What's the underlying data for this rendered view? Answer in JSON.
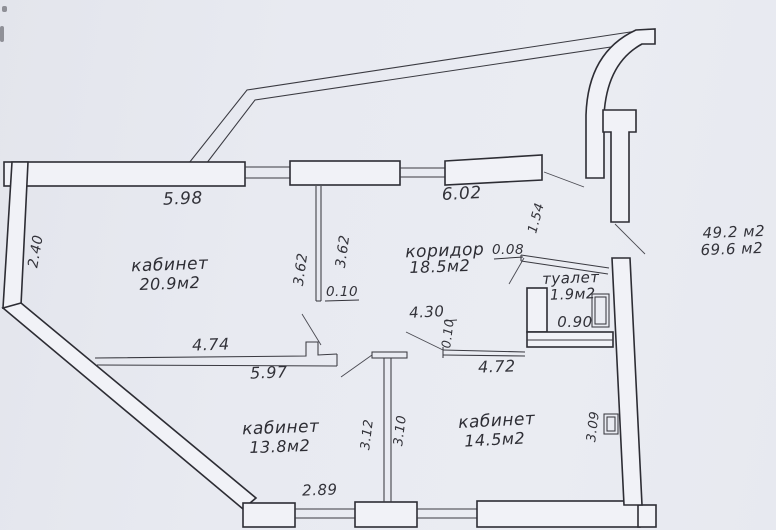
{
  "plan": {
    "rooms": [
      {
        "name": "кабинет",
        "area": "20.9м2"
      },
      {
        "name": "коридор",
        "area": "18.5м2"
      },
      {
        "name": "туалет",
        "area": "1.9м2"
      },
      {
        "name": "кабинет",
        "area": "13.8м2"
      },
      {
        "name": "кабинет",
        "area": "14.5м2"
      }
    ],
    "totals": {
      "area_line1": "49.2 м2",
      "area_line2": "69.6 м2"
    },
    "dimensions": {
      "top_wall_left": "5.98",
      "top_wall_right": "6.02",
      "left_wall": "2.40",
      "partition_left_side": "3.62",
      "partition_right_side": "3.62",
      "partition_thickness": "0.10",
      "entry_niche": "1.54",
      "toilet_offset": "0.08",
      "toilet_width": "0.90",
      "office1_wall_upper": "4.74",
      "office1_wall_lower": "5.97",
      "corridor_opening": "4.30",
      "corridor_wall_thickness": "0.10",
      "office3_top_wall": "4.72",
      "office2_height": "3.12",
      "office3_height": "3.10",
      "office3_right": "3.09",
      "office2_bottom": "2.89"
    }
  }
}
